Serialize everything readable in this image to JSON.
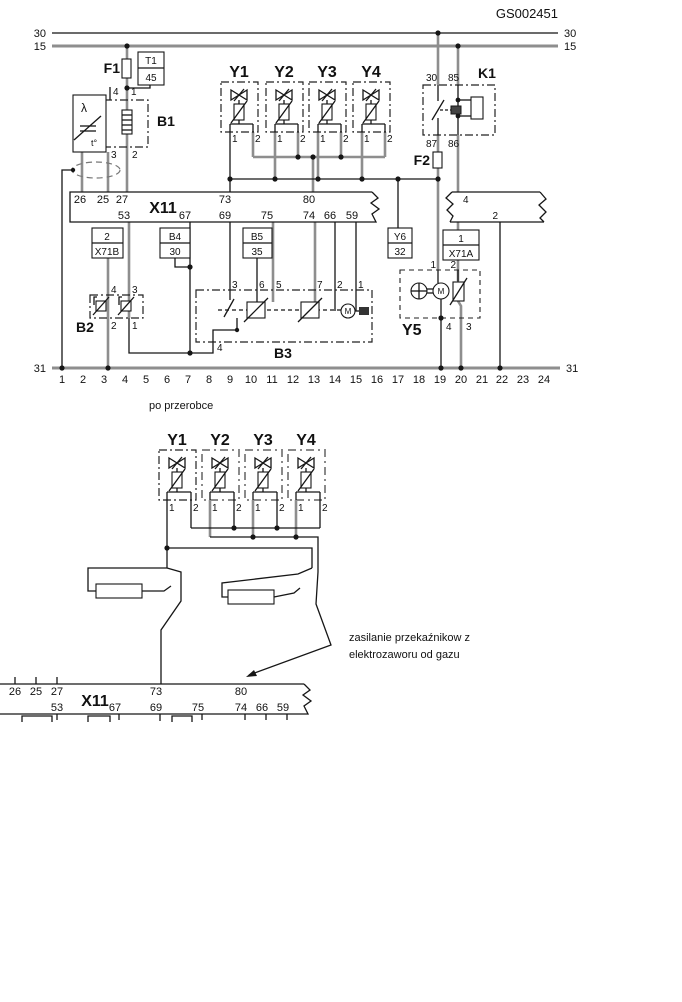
{
  "title_code": "GS002451",
  "d1": {
    "bus30": "30",
    "bus15": "15",
    "bus31": "31",
    "f1": "F1",
    "f2": "F2",
    "t1": {
      "top": "T1",
      "bot": "45"
    },
    "b1": {
      "name": "B1",
      "p4": "4",
      "p1": "1",
      "p3": "3",
      "p2": "2",
      "lambda": "λ",
      "temp": "t°"
    },
    "valves": [
      {
        "name": "Y1",
        "p1": "1",
        "p2": "2"
      },
      {
        "name": "Y2",
        "p1": "1",
        "p2": "2"
      },
      {
        "name": "Y3",
        "p1": "1",
        "p2": "2"
      },
      {
        "name": "Y4",
        "p1": "1",
        "p2": "2"
      }
    ],
    "k1": {
      "name": "K1",
      "p30": "30",
      "p85": "85",
      "p87": "87",
      "p86": "86"
    },
    "x11": {
      "name": "X11",
      "t26": "26",
      "t25": "25",
      "t27": "27",
      "t73": "73",
      "t80": "80",
      "b53": "53",
      "b67": "67",
      "b69": "69",
      "b75": "75",
      "b74": "74",
      "b66": "66",
      "b59": "59"
    },
    "conn": {
      "p4": "4",
      "p2": "2"
    },
    "x71b": {
      "top": "2",
      "bot": "X71B"
    },
    "b4": {
      "top": "B4",
      "bot": "30"
    },
    "b5": {
      "top": "B5",
      "bot": "35"
    },
    "y6": {
      "top": "Y6",
      "bot": "32"
    },
    "x71a": {
      "top": "1",
      "bot": "X71A"
    },
    "b2": {
      "name": "B2",
      "p4": "4",
      "p3": "3",
      "p2": "2",
      "p1": "1"
    },
    "b3": {
      "name": "B3",
      "p3": "3",
      "p6": "6",
      "p5": "5",
      "p7": "7",
      "p2": "2",
      "p1": "1",
      "p4": "4",
      "motor": "M"
    },
    "y5": {
      "name": "Y5",
      "p1": "1",
      "p2": "2",
      "p4": "4",
      "p3": "3",
      "motor": "M"
    },
    "tracks": [
      "1",
      "2",
      "3",
      "4",
      "5",
      "6",
      "7",
      "8",
      "9",
      "10",
      "11",
      "12",
      "13",
      "14",
      "15",
      "16",
      "17",
      "18",
      "19",
      "20",
      "21",
      "22",
      "23",
      "24"
    ]
  },
  "caption": "po przerobce",
  "d2": {
    "valves": [
      {
        "name": "Y1",
        "p1": "1",
        "p2": "2"
      },
      {
        "name": "Y2",
        "p1": "1",
        "p2": "2"
      },
      {
        "name": "Y3",
        "p1": "1",
        "p2": "2"
      },
      {
        "name": "Y4",
        "p1": "1",
        "p2": "2"
      }
    ],
    "x11": {
      "name": "X11",
      "t26": "26",
      "t25": "25",
      "t27": "27",
      "t73": "73",
      "t80": "80",
      "b53": "53",
      "b67": "67",
      "b69": "69",
      "b75": "75",
      "b74": "74",
      "b66": "66",
      "b59": "59"
    },
    "note1": "zasilanie przekaźnikow z",
    "note2": "elektrozaworu od gazu"
  }
}
